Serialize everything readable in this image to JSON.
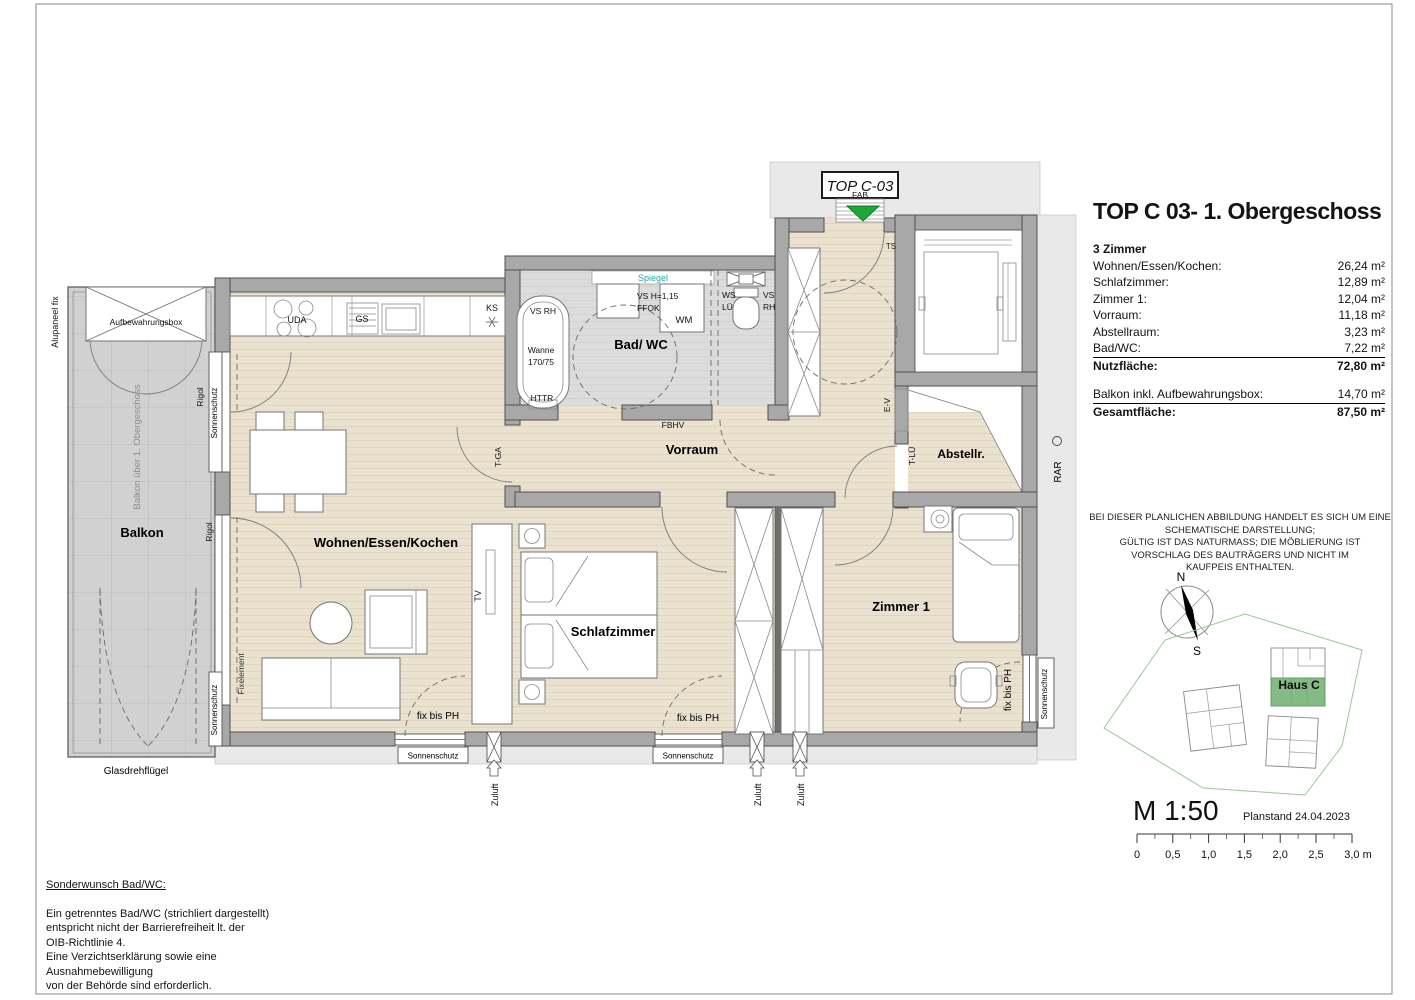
{
  "title_block": {
    "title": "TOP C 03- 1. Obergeschoss",
    "rooms_header": "3 Zimmer",
    "rows": [
      {
        "label": "Wohnen/Essen/Kochen:",
        "value": "26,24 m²"
      },
      {
        "label": "Schlafzimmer:",
        "value": "12,89 m²"
      },
      {
        "label": "Zimmer 1:",
        "value": "12,04 m²"
      },
      {
        "label": "Vorraum:",
        "value": "11,18 m²"
      },
      {
        "label": "Abstellraum:",
        "value": "3,23 m²"
      },
      {
        "label": "Bad/WC:",
        "value": "7,22 m²"
      }
    ],
    "nutzflaeche": {
      "label": "Nutzfläche:",
      "value": "72,80 m²"
    },
    "balkon_row": {
      "label": "Balkon inkl. Aufbewahrungsbox:",
      "value": "14,70 m²"
    },
    "gesamt_row": {
      "label": "Gesamtfläche:",
      "value": "87,50 m²"
    }
  },
  "disclaimer": [
    "BEI DIESER PLANLICHEN ABBILDUNG HANDELT ES SICH UM EINE",
    "SCHEMATISCHE DARSTELLUNG;",
    "GÜLTIG IST DAS NATURMASS; DIE MÖBLIERUNG IST",
    "VORSCHLAG DES BAUTRÄGERS UND NICHT IM",
    "KAUFPEIS ENTHALTEN."
  ],
  "compass": {
    "n": "N",
    "s": "S"
  },
  "site": {
    "haus": "Haus C"
  },
  "scale": {
    "m": "M 1:50",
    "planstand": "Planstand 24.04.2023",
    "ticks": [
      "0",
      "0,5",
      "1,0",
      "1,5",
      "2,0",
      "2,5",
      "3,0 m"
    ]
  },
  "note": {
    "heading": "Sonderwunsch Bad/WC:",
    "lines": [
      "Ein getrenntes Bad/WC (strichliert dargestellt)",
      "entspricht nicht der Barrierefreiheit lt. der",
      "OIB-Richtlinie 4.",
      "Eine Verzichtserklärung sowie eine",
      "Ausnahmebewilligung",
      "von der Behörde sind erforderlich."
    ]
  },
  "pl": {
    "top_c03": "TOP C-03",
    "fab": "FAB",
    "ts": "TS",
    "wohnen": "Wohnen/Essen/Kochen",
    "schlaf": "Schlafzimmer",
    "zimmer1": "Zimmer 1",
    "vorraum": "Vorraum",
    "badwc": "Bad/ WC",
    "abstellr": "Abstellr.",
    "balkon": "Balkon",
    "spiegel": "Spiegel",
    "vsrh": "VS RH",
    "wanne": "Wanne",
    "wanne2": "170/75",
    "httr": "HTTR",
    "vsh": "VS H=1,15",
    "ffok": "FFOK",
    "wm": "WM",
    "ws": "WS",
    "lue": "LÜ",
    "vs": "VS",
    "rh": "RH",
    "fbhv": "FBHV",
    "tga": "T-GA",
    "ev": "E-V",
    "tlue": "T-LÜ",
    "rar": "RAR",
    "ks": "KS",
    "uda": "UDA",
    "gs": "GS",
    "tv": "TV",
    "fixelement": "Fixelement",
    "fixbisph": "fix bis PH",
    "sonnenschutz": "Sonnenschutz",
    "rigol": "Rigol",
    "zuluft": "Zuluft",
    "alupaneel": "Alupaneel fix",
    "aufbox": "Aufbewahrungsbox",
    "balkonueber": "Balkon über 1. Obergeschoss",
    "glasdreh": "Glasdrehflügel"
  },
  "colors": {
    "floor_beige": "#eae2cf",
    "bath_gray": "#dcdcdc",
    "balcony_gray": "#d1d1d1",
    "wall_gray": "#a8a8a8",
    "entry_green": "#1fa83a",
    "haus_green": "#85b985",
    "spiegel_teal": "#2ba7a7",
    "site_boundary_green": "#9bc49b"
  }
}
